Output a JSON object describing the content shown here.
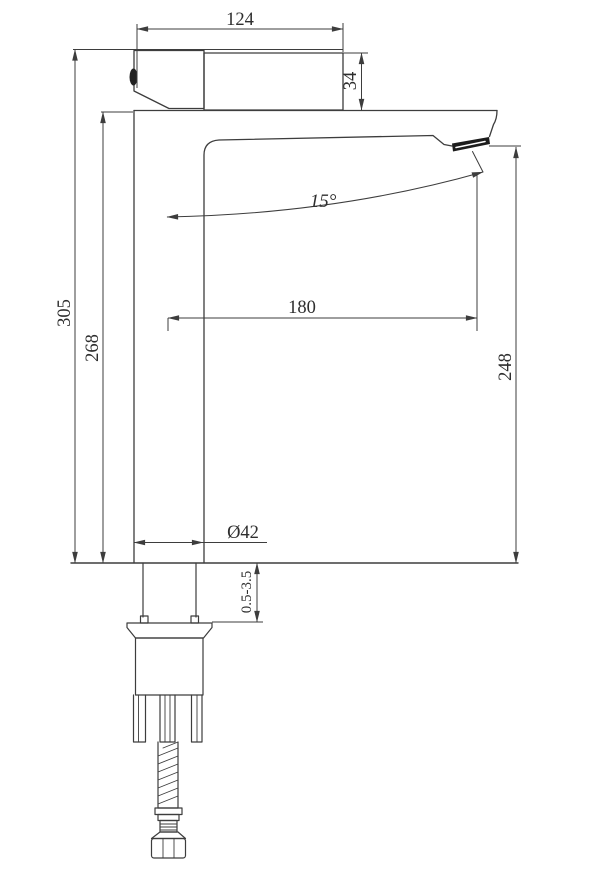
{
  "meta": {
    "background_color": "#ffffff",
    "line_color": "#3d3d3d",
    "text_color": "#2e2e2e",
    "drawing_subject": "tall basin mixer faucet side elevation with dimensions"
  },
  "labels": {
    "width_top": "124",
    "handle_height": "34",
    "overall_height": "305",
    "body_height": "268",
    "spout_reach": "180",
    "outlet_height": "248",
    "spout_angle": "15°",
    "body_diameter": "Ø42",
    "deck_thickness": "0.5-3.5"
  }
}
